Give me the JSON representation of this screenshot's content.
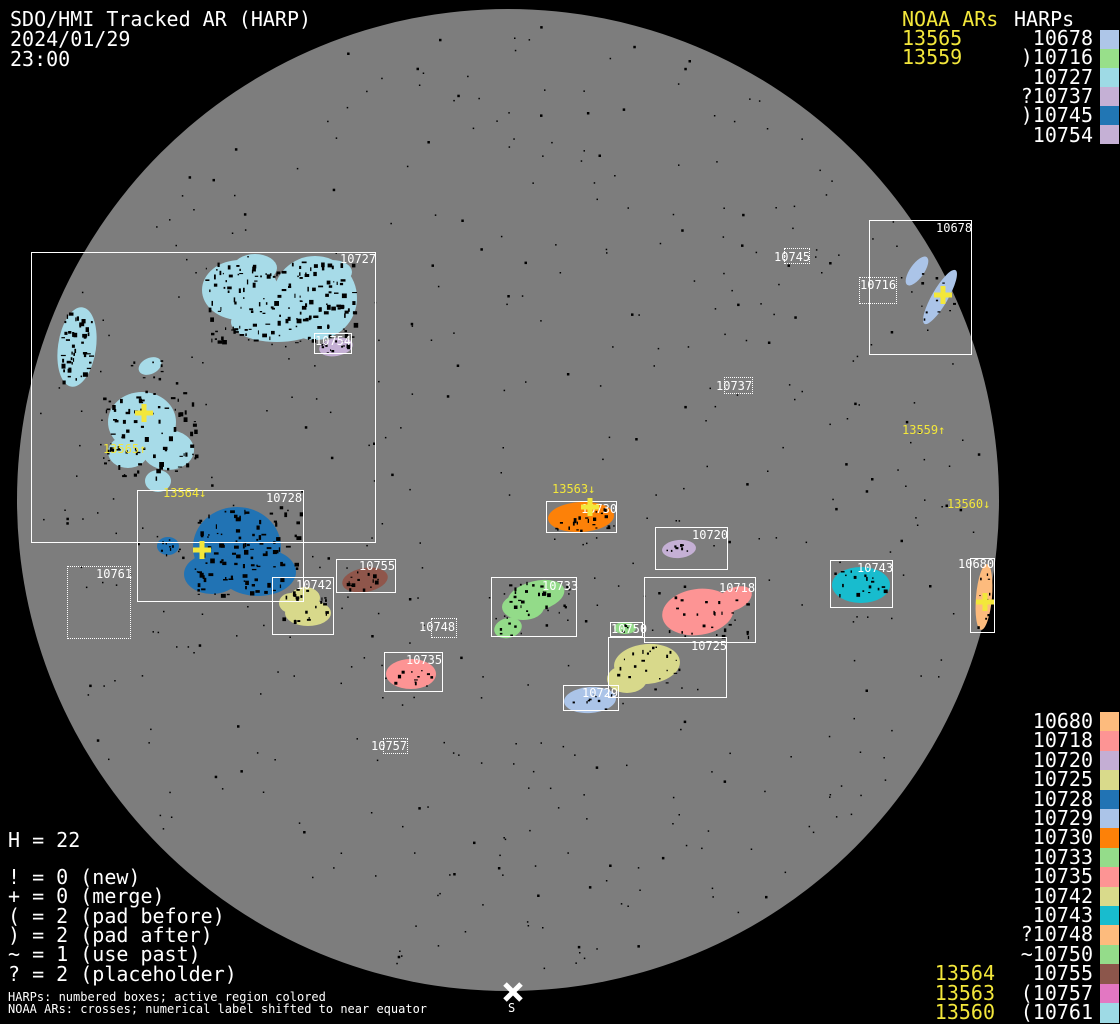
{
  "header": {
    "title": "SDO/HMI Tracked AR (HARP)",
    "date": "2024/01/29",
    "time": "23:00"
  },
  "colors": {
    "background": "#000000",
    "disk": "#7d7d7d",
    "speckle": "#000000",
    "text_white": "#ffffff",
    "text_yellow": "#f3e73b",
    "box_border": "#ffffff"
  },
  "top_right_legend": {
    "noaa_col_label": "NOAA ARs",
    "harp_col_label": "HARPs",
    "rows": [
      {
        "noaa": "13565",
        "harp": "10678",
        "prefix": "",
        "color": "#aec6e8"
      },
      {
        "noaa": "13559",
        "harp": "10716",
        "prefix": ")",
        "color": "#98df8a"
      },
      {
        "noaa": "",
        "harp": "10727",
        "prefix": "",
        "color": "#9edae5"
      },
      {
        "noaa": "",
        "harp": "10737",
        "prefix": "?",
        "color": "#c5b0d5"
      },
      {
        "noaa": "",
        "harp": "10745",
        "prefix": ")",
        "color": "#2176b4"
      },
      {
        "noaa": "",
        "harp": "10754",
        "prefix": "",
        "color": "#c5b0d5"
      }
    ]
  },
  "bottom_right_legend": {
    "rows": [
      {
        "harp": "10680",
        "prefix": "",
        "color": "#fdbb7d"
      },
      {
        "harp": "10718",
        "prefix": "",
        "color": "#fd9494"
      },
      {
        "harp": "10720",
        "prefix": "",
        "color": "#c4aed4"
      },
      {
        "harp": "10725",
        "prefix": "",
        "color": "#d9da8b"
      },
      {
        "harp": "10728",
        "prefix": "",
        "color": "#2173b4"
      },
      {
        "harp": "10729",
        "prefix": "",
        "color": "#abc4e8"
      },
      {
        "harp": "10730",
        "prefix": "",
        "color": "#fd8108"
      },
      {
        "harp": "10733",
        "prefix": "",
        "color": "#94dc8a"
      },
      {
        "harp": "10735",
        "prefix": "",
        "color": "#fd9494"
      },
      {
        "harp": "10742",
        "prefix": "",
        "color": "#d9da8b"
      },
      {
        "harp": "10743",
        "prefix": "",
        "color": "#18bcce"
      },
      {
        "harp": "10748",
        "prefix": "?",
        "color": "#fdbb7d"
      },
      {
        "harp": "10750",
        "prefix": "~",
        "color": "#94dc8a"
      },
      {
        "harp": "10755",
        "prefix": "",
        "color": "#8c564b"
      },
      {
        "harp": "10757",
        "prefix": "(",
        "color": "#e377c2"
      },
      {
        "harp": "10761",
        "prefix": "(",
        "color": "#9edae5"
      }
    ],
    "noaa_labels": [
      {
        "text": "13564",
        "row_index": 13
      },
      {
        "text": "13563",
        "row_index": 14
      },
      {
        "text": "13560",
        "row_index": 15
      }
    ]
  },
  "bottom_left": {
    "h_count": "H = 22",
    "flag_legend": [
      "! = 0 (new)",
      "+ = 0 (merge)",
      "( = 2 (pad before)",
      ") = 2 (pad after)",
      "~ = 1 (use past)",
      "? = 2 (placeholder)"
    ],
    "footnote1": "HARPs: numbered boxes; active region colored",
    "footnote2": "NOAA ARs: crosses; numerical label shifted to near equator"
  },
  "south_marker": {
    "label": "S",
    "x": 513,
    "y": 992
  },
  "disk": {
    "cx": 508,
    "cy": 500,
    "r": 491
  },
  "regions": [
    {
      "harp": "10727",
      "style": "solid",
      "box": [
        31,
        252,
        345,
        291
      ],
      "label_x": 340,
      "label_y": 253
    },
    {
      "harp": "10754",
      "style": "solid",
      "box": [
        314,
        333,
        38,
        21
      ],
      "label_x": 315,
      "label_y": 335
    },
    {
      "harp": "10728",
      "style": "solid",
      "box": [
        137,
        490,
        167,
        112
      ],
      "label_x": 266,
      "label_y": 492
    },
    {
      "harp": "10761",
      "style": "dotted",
      "box": [
        67,
        566,
        64,
        73
      ],
      "label_x": 96,
      "label_y": 568
    },
    {
      "harp": "10742",
      "style": "solid",
      "box": [
        272,
        577,
        62,
        58
      ],
      "label_x": 296,
      "label_y": 579
    },
    {
      "harp": "10755",
      "style": "solid",
      "box": [
        336,
        559,
        60,
        34
      ],
      "label_x": 359,
      "label_y": 560
    },
    {
      "harp": "10735",
      "style": "solid",
      "box": [
        384,
        652,
        59,
        40
      ],
      "label_x": 406,
      "label_y": 654
    },
    {
      "harp": "10748",
      "style": "dotted",
      "box": [
        431,
        618,
        26,
        20
      ],
      "label_x": 419,
      "label_y": 621
    },
    {
      "harp": "10733",
      "style": "solid",
      "box": [
        491,
        577,
        86,
        60
      ],
      "label_x": 542,
      "label_y": 580
    },
    {
      "harp": "10730",
      "style": "solid",
      "box": [
        546,
        501,
        71,
        32
      ],
      "label_x": 581,
      "label_y": 503
    },
    {
      "harp": "10720",
      "style": "solid",
      "box": [
        655,
        527,
        73,
        43
      ],
      "label_x": 692,
      "label_y": 529
    },
    {
      "harp": "10718",
      "style": "solid",
      "box": [
        644,
        577,
        112,
        66
      ],
      "label_x": 719,
      "label_y": 582
    },
    {
      "harp": "10750",
      "style": "solid",
      "box": [
        610,
        622,
        33,
        15
      ],
      "label_x": 611,
      "label_y": 623
    },
    {
      "harp": "10725",
      "style": "solid",
      "box": [
        608,
        637,
        119,
        61
      ],
      "label_x": 691,
      "label_y": 640
    },
    {
      "harp": "10729",
      "style": "solid",
      "box": [
        563,
        685,
        56,
        26
      ],
      "label_x": 582,
      "label_y": 687
    },
    {
      "harp": "10757",
      "style": "dotted",
      "box": [
        383,
        738,
        25,
        16
      ],
      "label_x": 371,
      "label_y": 740
    },
    {
      "harp": "10743",
      "style": "solid",
      "box": [
        830,
        560,
        63,
        48
      ],
      "label_x": 857,
      "label_y": 562
    },
    {
      "harp": "10680",
      "style": "solid",
      "box": [
        970,
        558,
        25,
        75
      ],
      "label_x": 958,
      "label_y": 558
    },
    {
      "harp": "10678",
      "style": "solid",
      "box": [
        869,
        220,
        103,
        135
      ],
      "label_x": 936,
      "label_y": 222
    },
    {
      "harp": "10716",
      "style": "dotted",
      "box": [
        859,
        277,
        38,
        27
      ],
      "label_x": 860,
      "label_y": 279
    },
    {
      "harp": "10745",
      "style": "dotted",
      "box": [
        784,
        248,
        26,
        16
      ],
      "label_x": 774,
      "label_y": 251
    },
    {
      "harp": "10737",
      "style": "dotted",
      "box": [
        724,
        377,
        29,
        17
      ],
      "label_x": 716,
      "label_y": 380
    }
  ],
  "noaa_disk_labels": [
    {
      "text": "13565↑",
      "x": 103,
      "y": 443
    },
    {
      "text": "13564↓",
      "x": 163,
      "y": 487
    },
    {
      "text": "13563↓",
      "x": 552,
      "y": 483
    },
    {
      "text": "13559↑",
      "x": 902,
      "y": 424
    },
    {
      "text": "13560↓",
      "x": 947,
      "y": 498
    }
  ],
  "noaa_crosses": [
    {
      "x": 144,
      "y": 413
    },
    {
      "x": 202,
      "y": 550
    },
    {
      "x": 590,
      "y": 507
    },
    {
      "x": 943,
      "y": 295
    },
    {
      "x": 985,
      "y": 602
    }
  ],
  "blobs": [
    {
      "harp": "10727",
      "color": "#a7dbe8",
      "ellipses": [
        [
          240,
          290,
          38,
          30,
          0
        ],
        [
          315,
          298,
          42,
          42,
          0
        ],
        [
          277,
          322,
          46,
          20,
          0
        ],
        [
          255,
          268,
          22,
          14,
          0
        ],
        [
          332,
          272,
          20,
          12,
          0
        ],
        [
          77,
          347,
          19,
          40,
          8
        ],
        [
          150,
          366,
          12,
          8,
          -25
        ],
        [
          142,
          422,
          34,
          30,
          0
        ],
        [
          168,
          450,
          26,
          20,
          0
        ],
        [
          128,
          452,
          20,
          16,
          0
        ],
        [
          158,
          481,
          13,
          11,
          0
        ]
      ]
    },
    {
      "harp": "10728",
      "color": "#2173b4",
      "ellipses": [
        [
          237,
          547,
          44,
          40,
          0
        ],
        [
          258,
          572,
          38,
          24,
          0
        ],
        [
          212,
          574,
          28,
          20,
          0
        ],
        [
          168,
          546,
          11,
          9,
          0
        ]
      ]
    },
    {
      "harp": "10754",
      "color": "#c5b0d5",
      "ellipses": [
        [
          336,
          347,
          17,
          9,
          -10
        ]
      ]
    },
    {
      "harp": "10720",
      "color": "#c5b0d5",
      "ellipses": [
        [
          679,
          549,
          17,
          9,
          -5
        ]
      ]
    },
    {
      "harp": "10742",
      "color": "#d8d98b",
      "ellipses": [
        [
          305,
          598,
          15,
          11,
          0
        ],
        [
          308,
          613,
          23,
          13,
          0
        ],
        [
          291,
          603,
          12,
          10,
          0
        ]
      ]
    },
    {
      "harp": "10725",
      "color": "#d8d98b",
      "ellipses": [
        [
          647,
          664,
          33,
          20,
          -5
        ],
        [
          627,
          679,
          20,
          14,
          0
        ]
      ]
    },
    {
      "harp": "10755",
      "color": "#8f564b",
      "ellipses": [
        [
          365,
          580,
          23,
          12,
          -10
        ]
      ]
    },
    {
      "harp": "10735",
      "color": "#fd9494",
      "ellipses": [
        [
          411,
          674,
          25,
          15,
          0
        ]
      ]
    },
    {
      "harp": "10718",
      "color": "#fd9494",
      "ellipses": [
        [
          698,
          612,
          36,
          23,
          -8
        ],
        [
          734,
          599,
          19,
          11,
          -25
        ]
      ]
    },
    {
      "harp": "10733",
      "color": "#93db89",
      "ellipses": [
        [
          536,
          596,
          29,
          15,
          -14
        ],
        [
          523,
          607,
          21,
          13,
          0
        ],
        [
          508,
          628,
          14,
          10,
          -15
        ]
      ]
    },
    {
      "harp": "10750",
      "color": "#93db89",
      "ellipses": [
        [
          625,
          628,
          11,
          6,
          0
        ]
      ]
    },
    {
      "harp": "10729",
      "color": "#abc4e8",
      "ellipses": [
        [
          590,
          700,
          26,
          13,
          -4
        ]
      ]
    },
    {
      "harp": "10716",
      "color": "#abc4e8",
      "ellipses": [
        [
          917,
          271,
          7,
          17,
          35
        ],
        [
          940,
          297,
          8,
          31,
          30
        ]
      ]
    },
    {
      "harp": "10743",
      "color": "#18bcce",
      "ellipses": [
        [
          861,
          585,
          29,
          18,
          0
        ]
      ]
    },
    {
      "harp": "10680",
      "color": "#fdbb7d",
      "ellipses": [
        [
          984,
          597,
          8,
          33,
          5
        ]
      ]
    },
    {
      "harp": "10730",
      "color": "#fd8108",
      "ellipses": [
        [
          581,
          517,
          33,
          15,
          -3
        ]
      ]
    }
  ],
  "speckle_clusters": [
    [
      205,
      260,
      150,
      85,
      160,
      4
    ],
    [
      60,
      312,
      32,
      70,
      45,
      4
    ],
    [
      103,
      392,
      92,
      85,
      80,
      4
    ],
    [
      128,
      360,
      40,
      18,
      8,
      2
    ],
    [
      195,
      505,
      105,
      92,
      100,
      4
    ],
    [
      158,
      538,
      22,
      18,
      8,
      2
    ],
    [
      320,
      340,
      30,
      13,
      10,
      2
    ],
    [
      282,
      588,
      48,
      38,
      22,
      3
    ],
    [
      345,
      570,
      40,
      20,
      14,
      3
    ],
    [
      392,
      664,
      40,
      20,
      10,
      3
    ],
    [
      508,
      580,
      62,
      36,
      26,
      3
    ],
    [
      496,
      620,
      26,
      16,
      6,
      2
    ],
    [
      552,
      506,
      58,
      24,
      22,
      3
    ],
    [
      666,
      542,
      26,
      13,
      6,
      2
    ],
    [
      668,
      592,
      80,
      44,
      26,
      3
    ],
    [
      614,
      648,
      66,
      44,
      18,
      3
    ],
    [
      570,
      692,
      42,
      18,
      8,
      2
    ],
    [
      838,
      570,
      48,
      32,
      16,
      3
    ],
    [
      618,
      623,
      16,
      9,
      3,
      2
    ],
    [
      977,
      572,
      14,
      55,
      10,
      2
    ],
    [
      912,
      262,
      44,
      58,
      12,
      2
    ]
  ],
  "chart_data": {
    "type": "table",
    "title": "SDO/HMI Tracked AR (HARP) 2024/01/29 23:00",
    "columns": [
      "NOAA AR",
      "flag",
      "HARP",
      "color"
    ],
    "rows": [
      [
        "13565",
        "",
        "10678",
        "#aec6e8"
      ],
      [
        "13559",
        ")",
        "10716",
        "#98df8a"
      ],
      [
        "",
        "",
        "10727",
        "#9edae5"
      ],
      [
        "",
        "?",
        "10737",
        "#c5b0d5"
      ],
      [
        "",
        ")",
        "10745",
        "#2176b4"
      ],
      [
        "",
        "",
        "10754",
        "#c5b0d5"
      ],
      [
        "",
        "",
        "10680",
        "#fdbb7d"
      ],
      [
        "",
        "",
        "10718",
        "#fd9494"
      ],
      [
        "",
        "",
        "10720",
        "#c4aed4"
      ],
      [
        "",
        "",
        "10725",
        "#d9da8b"
      ],
      [
        "",
        "",
        "10728",
        "#2173b4"
      ],
      [
        "",
        "",
        "10729",
        "#abc4e8"
      ],
      [
        "",
        "",
        "10730",
        "#fd8108"
      ],
      [
        "",
        "",
        "10733",
        "#94dc8a"
      ],
      [
        "",
        "",
        "10735",
        "#fd9494"
      ],
      [
        "",
        "",
        "10742",
        "#d9da8b"
      ],
      [
        "",
        "",
        "10743",
        "#18bcce"
      ],
      [
        "",
        "?",
        "10748",
        "#fdbb7d"
      ],
      [
        "",
        "~",
        "10750",
        "#94dc8a"
      ],
      [
        "13564",
        "",
        "10755",
        "#8c564b"
      ],
      [
        "13563",
        "(",
        "10757",
        "#e377c2"
      ],
      [
        "13560",
        "(",
        "10761",
        "#9edae5"
      ]
    ]
  }
}
